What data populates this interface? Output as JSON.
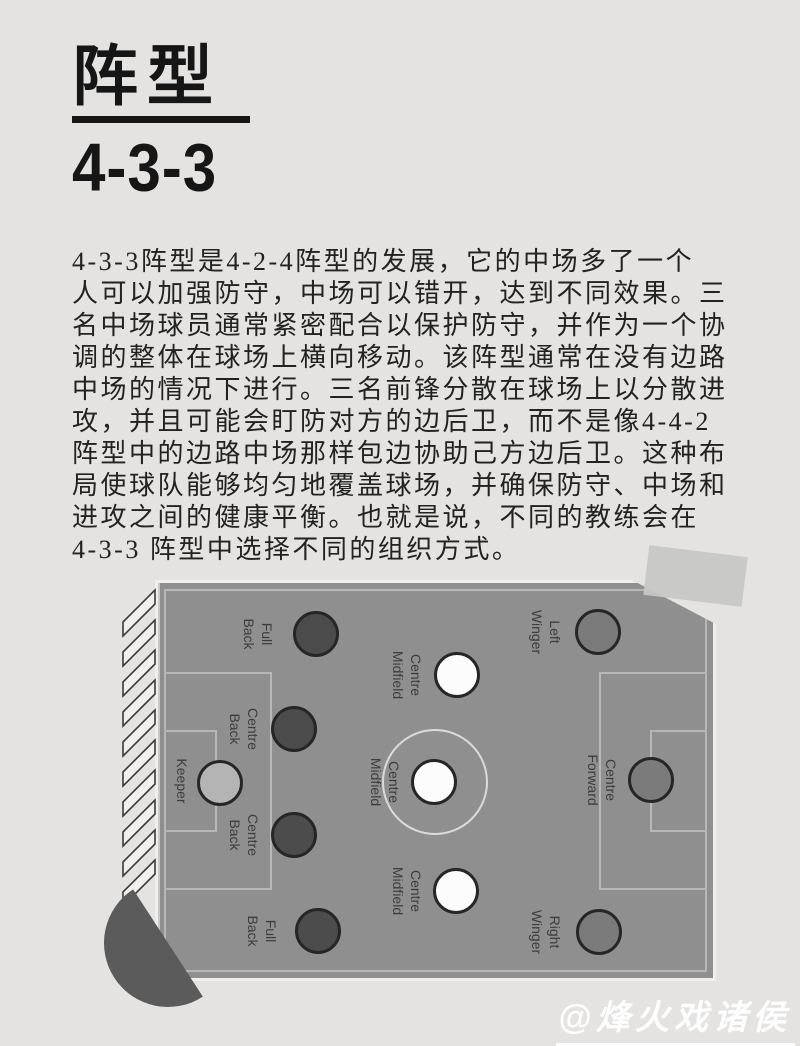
{
  "header": {
    "title": "阵型",
    "subtitle": "4-3-3"
  },
  "paragraph": {
    "lines": [
      "4-3-3阵型是4-2-4阵型的发展，它的中场多了一个",
      "人可以加强防守，中场可以错开，达到不同效果。三",
      "名中场球员通常紧密配合以保护防守，并作为一个协",
      "调的整体在球场上横向移动。该阵型通常在没有边路",
      "中场的情况下进行。三名前锋分散在球场上以分散进",
      "攻，并且可能会盯防对方的边后卫，而不是像4-4-2",
      "阵型中的边路中场那样包边协助己方边后卫。这种布",
      "局使球队能够均匀地覆盖球场，并确保防守、中场和",
      "进攻之间的健康平衡。也就是说，不同的教练会在",
      "4-3-3 阵型中选择不同的组织方式。"
    ]
  },
  "diagram": {
    "type": "football-formation",
    "formation": "4-3-3",
    "orientation": "goal-on-left",
    "positions": [
      {
        "id": "keeper",
        "lines": [
          "Keeper"
        ],
        "type": "keeper",
        "cx": 62,
        "cy": 200,
        "lx": 24,
        "ly": 198
      },
      {
        "id": "full-back-top",
        "lines": [
          "Full",
          "Back"
        ],
        "type": "defender",
        "cx": 158,
        "cy": 51,
        "lx": 100,
        "ly": 51
      },
      {
        "id": "centre-back-top",
        "lines": [
          "Centre",
          "Back"
        ],
        "type": "defender",
        "cx": 136,
        "cy": 146,
        "lx": 86,
        "ly": 146
      },
      {
        "id": "centre-back-bottom",
        "lines": [
          "Centre",
          "Back"
        ],
        "type": "defender",
        "cx": 136,
        "cy": 252,
        "lx": 86,
        "ly": 252
      },
      {
        "id": "full-back-bottom",
        "lines": [
          "Full",
          "Back"
        ],
        "type": "defender",
        "cx": 160,
        "cy": 348,
        "lx": 104,
        "ly": 348
      },
      {
        "id": "centre-midfield-top",
        "lines": [
          "Centre",
          "Midfield"
        ],
        "type": "midfielder",
        "cx": 299,
        "cy": 92,
        "lx": 249,
        "ly": 92
      },
      {
        "id": "centre-midfield-mid",
        "lines": [
          "Centre",
          "Midfield"
        ],
        "type": "midfielder",
        "cx": 276,
        "cy": 199,
        "lx": 227,
        "ly": 199
      },
      {
        "id": "centre-midfield-bottom",
        "lines": [
          "Centre",
          "Midfield"
        ],
        "type": "midfielder",
        "cx": 298,
        "cy": 308,
        "lx": 249,
        "ly": 308
      },
      {
        "id": "left-winger",
        "lines": [
          "Left",
          "Winger"
        ],
        "type": "forward",
        "cx": 440,
        "cy": 49,
        "lx": 388,
        "ly": 49
      },
      {
        "id": "centre-forward",
        "lines": [
          "Centre",
          "Forward"
        ],
        "type": "forward",
        "cx": 493,
        "cy": 197,
        "lx": 444,
        "ly": 197
      },
      {
        "id": "right-winger",
        "lines": [
          "Right",
          "Winger"
        ],
        "type": "forward",
        "cx": 441,
        "cy": 349,
        "lx": 388,
        "ly": 349
      }
    ]
  },
  "watermark": {
    "text": "@烽火戏诸侯"
  },
  "colors": {
    "page_bg": "#e4e3e1",
    "pitch": "#8f8f8f",
    "pitch_line": "#b7b7b7",
    "halfway_line": "#c9c9c9",
    "centre_circle_line": "#dadada",
    "photo_border": "#efeeec",
    "keeper_fill": "#b4b4b4",
    "defender_fill": "#4c4c4c",
    "midfielder_fill": "#fcfcfc",
    "forward_fill": "#7b7b7b",
    "marker_stroke": "#262626",
    "label_text": "#3c3c3c",
    "title_text": "#161616",
    "body_text": "#222222",
    "fan": "#5b5b5b",
    "tape": "#c7c7c6",
    "hatch_stroke": "#3a3a3a",
    "watermark": "#ffffff"
  }
}
